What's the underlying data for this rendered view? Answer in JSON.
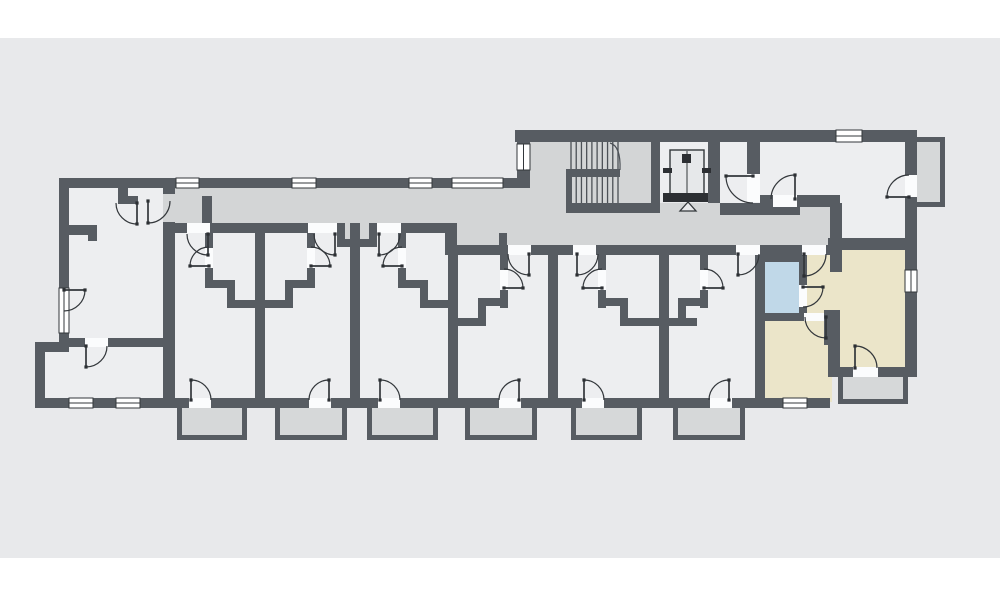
{
  "meta": {
    "title": "Apartment building floor plan",
    "canvas_w": 1000,
    "canvas_h": 600
  },
  "palette": {
    "page_bg": "#ffffff",
    "panel_bg": "#e8e9eb",
    "room": "#edeef0",
    "corridor": "#d3d5d6",
    "balcony": "#d6d8d9",
    "highlight_beige": "#ebe5c9",
    "highlight_blue": "#c0d8e8",
    "wall": "#575c62",
    "line": "#33373b",
    "stair_line": "#4b5056",
    "dark": "#2c2f33",
    "threshold": "#fbfcfd"
  },
  "panel": {
    "x": 0,
    "y": 38,
    "w": 1000,
    "h": 520
  },
  "plan": {
    "room_fills": [
      {
        "n": "room-left-lower",
        "x": 35,
        "y": 342,
        "w": 34,
        "h": 66
      },
      {
        "n": "room-left-wing",
        "x": 59,
        "y": 178,
        "w": 116,
        "h": 230
      },
      {
        "n": "rooms-strip",
        "x": 163,
        "y": 223,
        "w": 667,
        "h": 185
      },
      {
        "n": "room-top-right",
        "x": 718,
        "y": 142,
        "w": 189,
        "h": 100
      },
      {
        "n": "elevator-shaft",
        "x": 660,
        "y": 142,
        "w": 48,
        "h": 58
      }
    ],
    "corridor_fills": [
      {
        "n": "corridor-west",
        "x": 163,
        "y": 188,
        "w": 290,
        "h": 35
      },
      {
        "n": "corridor-mid",
        "x": 453,
        "y": 188,
        "w": 74,
        "h": 57
      },
      {
        "n": "stairwell",
        "x": 527,
        "y": 142,
        "w": 133,
        "h": 103
      },
      {
        "n": "corridor-east",
        "x": 652,
        "y": 203,
        "w": 186,
        "h": 42
      },
      {
        "n": "corridor-niche",
        "x": 345,
        "y": 223,
        "w": 24,
        "h": 16
      }
    ],
    "unit_fills": [
      {
        "n": "unit-hall",
        "x": 760,
        "y": 245,
        "w": 80,
        "h": 73,
        "c": "highlight_beige"
      },
      {
        "n": "unit-bedroom",
        "x": 755,
        "y": 318,
        "w": 77,
        "h": 84,
        "c": "highlight_beige"
      },
      {
        "n": "unit-living-room",
        "x": 832,
        "y": 242,
        "w": 75,
        "h": 133,
        "c": "highlight_beige"
      },
      {
        "n": "unit-bathroom",
        "x": 759,
        "y": 256,
        "w": 46,
        "h": 60,
        "c": "highlight_blue"
      }
    ],
    "balconies": [
      {
        "n": "balcony-1",
        "x": 177,
        "y": 408,
        "w": 70,
        "h": 32,
        "open": "top"
      },
      {
        "n": "balcony-2",
        "x": 275,
        "y": 408,
        "w": 72,
        "h": 32,
        "open": "top"
      },
      {
        "n": "balcony-3",
        "x": 367,
        "y": 408,
        "w": 71,
        "h": 32,
        "open": "top"
      },
      {
        "n": "balcony-4",
        "x": 465,
        "y": 408,
        "w": 72,
        "h": 32,
        "open": "top"
      },
      {
        "n": "balcony-5",
        "x": 571,
        "y": 408,
        "w": 71,
        "h": 32,
        "open": "top"
      },
      {
        "n": "balcony-6",
        "x": 673,
        "y": 408,
        "w": 72,
        "h": 32,
        "open": "top"
      },
      {
        "n": "balcony-unit",
        "x": 838,
        "y": 377,
        "w": 70,
        "h": 27,
        "open": "top"
      },
      {
        "n": "balcony-top-right",
        "x": 917,
        "y": 137,
        "w": 28,
        "h": 70,
        "open": "left"
      }
    ],
    "walls": [
      [
        59,
        178,
        468,
        10
      ],
      [
        59,
        178,
        10,
        112
      ],
      [
        59,
        333,
        10,
        14
      ],
      [
        35,
        342,
        34,
        10
      ],
      [
        35,
        342,
        10,
        66
      ],
      [
        35,
        398,
        140,
        10
      ],
      [
        163,
        188,
        12,
        6
      ],
      [
        163,
        222,
        12,
        176
      ],
      [
        118,
        188,
        10,
        16
      ],
      [
        118,
        196,
        20,
        8
      ],
      [
        60,
        225,
        37,
        10
      ],
      [
        88,
        225,
        9,
        16
      ],
      [
        69,
        338,
        16,
        9
      ],
      [
        108,
        338,
        57,
        9
      ],
      [
        163,
        223,
        24,
        10
      ],
      [
        210,
        223,
        98,
        10
      ],
      [
        337,
        223,
        8,
        24
      ],
      [
        369,
        223,
        8,
        24
      ],
      [
        337,
        239,
        40,
        8
      ],
      [
        401,
        223,
        49,
        10
      ],
      [
        202,
        196,
        10,
        27
      ],
      [
        445,
        223,
        12,
        32
      ],
      [
        499,
        233,
        8,
        12
      ],
      [
        445,
        245,
        63,
        10
      ],
      [
        531,
        245,
        42,
        10
      ],
      [
        596,
        245,
        140,
        10
      ],
      [
        760,
        245,
        42,
        10
      ],
      [
        826,
        245,
        16,
        10
      ],
      [
        255,
        223,
        10,
        175
      ],
      [
        350,
        223,
        10,
        175
      ],
      [
        448,
        255,
        10,
        143
      ],
      [
        548,
        255,
        10,
        143
      ],
      [
        659,
        255,
        10,
        143
      ],
      [
        755,
        255,
        10,
        143
      ],
      [
        175,
        398,
        14,
        10
      ],
      [
        211,
        398,
        98,
        10
      ],
      [
        331,
        398,
        47,
        10
      ],
      [
        400,
        398,
        99,
        10
      ],
      [
        521,
        398,
        61,
        10
      ],
      [
        604,
        398,
        106,
        10
      ],
      [
        731,
        398,
        99,
        10
      ],
      [
        205,
        233,
        8,
        15
      ],
      [
        205,
        268,
        8,
        20
      ],
      [
        205,
        280,
        30,
        8
      ],
      [
        227,
        280,
        8,
        28
      ],
      [
        227,
        300,
        30,
        8
      ],
      [
        307,
        233,
        8,
        15
      ],
      [
        307,
        268,
        8,
        20
      ],
      [
        285,
        280,
        30,
        8
      ],
      [
        285,
        280,
        8,
        28
      ],
      [
        265,
        300,
        28,
        8
      ],
      [
        398,
        233,
        8,
        15
      ],
      [
        398,
        268,
        8,
        20
      ],
      [
        398,
        280,
        30,
        8
      ],
      [
        420,
        280,
        8,
        28
      ],
      [
        420,
        300,
        30,
        8
      ],
      [
        500,
        255,
        8,
        15
      ],
      [
        500,
        290,
        8,
        18
      ],
      [
        478,
        298,
        30,
        8
      ],
      [
        478,
        298,
        8,
        28
      ],
      [
        458,
        318,
        28,
        8
      ],
      [
        598,
        255,
        8,
        15
      ],
      [
        598,
        290,
        8,
        18
      ],
      [
        598,
        298,
        30,
        8
      ],
      [
        620,
        298,
        8,
        28
      ],
      [
        620,
        318,
        39,
        8
      ],
      [
        700,
        255,
        8,
        15
      ],
      [
        700,
        290,
        8,
        18
      ],
      [
        678,
        298,
        30,
        8
      ],
      [
        678,
        298,
        8,
        28
      ],
      [
        669,
        318,
        28,
        8
      ],
      [
        515,
        130,
        402,
        12
      ],
      [
        517,
        141,
        13,
        47
      ],
      [
        566,
        203,
        94,
        10
      ],
      [
        651,
        142,
        9,
        67
      ],
      [
        708,
        142,
        12,
        61
      ],
      [
        720,
        203,
        80,
        12
      ],
      [
        747,
        142,
        13,
        32
      ],
      [
        760,
        195,
        13,
        12
      ],
      [
        797,
        195,
        43,
        12
      ],
      [
        830,
        203,
        12,
        69
      ],
      [
        828,
        238,
        80,
        12
      ],
      [
        755,
        254,
        47,
        8
      ],
      [
        799,
        254,
        8,
        31
      ],
      [
        799,
        307,
        8,
        6
      ],
      [
        755,
        313,
        49,
        8
      ],
      [
        824,
        313,
        10,
        32
      ],
      [
        824,
        310,
        16,
        10
      ],
      [
        828,
        320,
        12,
        47
      ],
      [
        828,
        367,
        25,
        10
      ],
      [
        878,
        367,
        30,
        10
      ],
      [
        905,
        133,
        12,
        42
      ],
      [
        905,
        197,
        12,
        73
      ],
      [
        905,
        292,
        12,
        85
      ]
    ],
    "thresholds": [
      [
        187,
        223,
        23,
        10
      ],
      [
        308,
        223,
        29,
        10
      ],
      [
        377,
        223,
        24,
        10
      ],
      [
        508,
        245,
        23,
        10
      ],
      [
        573,
        245,
        23,
        10
      ],
      [
        736,
        245,
        24,
        10
      ],
      [
        802,
        245,
        24,
        10
      ],
      [
        189,
        398,
        22,
        10
      ],
      [
        309,
        398,
        22,
        10
      ],
      [
        378,
        398,
        22,
        10
      ],
      [
        499,
        398,
        22,
        10
      ],
      [
        582,
        398,
        22,
        10
      ],
      [
        710,
        398,
        22,
        10
      ],
      [
        853,
        367,
        25,
        10
      ],
      [
        205,
        248,
        8,
        20
      ],
      [
        307,
        248,
        8,
        20
      ],
      [
        398,
        248,
        8,
        20
      ],
      [
        500,
        270,
        8,
        20
      ],
      [
        598,
        270,
        8,
        20
      ],
      [
        700,
        270,
        8,
        20
      ],
      [
        799,
        285,
        8,
        22
      ],
      [
        804,
        313,
        20,
        8
      ],
      [
        85,
        338,
        23,
        9
      ],
      [
        773,
        195,
        24,
        12
      ],
      [
        747,
        174,
        13,
        28
      ],
      [
        905,
        175,
        12,
        22
      ]
    ],
    "windows": [
      {
        "x": 176,
        "y": 178,
        "w": 23,
        "h": 10,
        "o": "h"
      },
      {
        "x": 292,
        "y": 178,
        "w": 24,
        "h": 10,
        "o": "h"
      },
      {
        "x": 409,
        "y": 178,
        "w": 23,
        "h": 10,
        "o": "h"
      },
      {
        "x": 452,
        "y": 178,
        "w": 51,
        "h": 10,
        "o": "h"
      },
      {
        "x": 836,
        "y": 130,
        "w": 26,
        "h": 12,
        "o": "h"
      },
      {
        "x": 59,
        "y": 288,
        "w": 10,
        "h": 45,
        "o": "v"
      },
      {
        "x": 69,
        "y": 398,
        "w": 24,
        "h": 10,
        "o": "h"
      },
      {
        "x": 116,
        "y": 398,
        "w": 24,
        "h": 10,
        "o": "h"
      },
      {
        "x": 783,
        "y": 398,
        "w": 24,
        "h": 10,
        "o": "h"
      },
      {
        "x": 905,
        "y": 270,
        "w": 12,
        "h": 22,
        "o": "v"
      },
      {
        "x": 517,
        "y": 144,
        "w": 13,
        "h": 26,
        "o": "v"
      }
    ],
    "doors": [
      {
        "n": "door-apt1-entry",
        "cx": 208,
        "cy": 234,
        "r": 21,
        "c": 180,
        "o": 90
      },
      {
        "n": "door-apt2-entry",
        "cx": 335,
        "cy": 234,
        "r": 21,
        "c": 180,
        "o": 90
      },
      {
        "n": "door-apt3-entry",
        "cx": 379,
        "cy": 234,
        "r": 21,
        "c": 0,
        "o": 90
      },
      {
        "n": "door-apt4-entry",
        "cx": 529,
        "cy": 254,
        "r": 21,
        "c": 180,
        "o": 90
      },
      {
        "n": "door-apt5-entry",
        "cx": 577,
        "cy": 254,
        "r": 21,
        "c": 0,
        "o": 90
      },
      {
        "n": "door-apt6-entry",
        "cx": 738,
        "cy": 254,
        "r": 21,
        "c": 0,
        "o": 90
      },
      {
        "n": "door-unit-entry",
        "cx": 804,
        "cy": 254,
        "r": 22,
        "c": 0,
        "o": 90
      },
      {
        "n": "door-unit-bathroom",
        "cx": 803,
        "cy": 287,
        "r": 20,
        "c": 90,
        "o": 0
      },
      {
        "n": "door-unit-bedroom",
        "cx": 826,
        "cy": 317,
        "r": 21,
        "c": 180,
        "o": 90
      },
      {
        "n": "door-unit-balcony",
        "cx": 855,
        "cy": 368,
        "r": 22,
        "c": 0,
        "o": 270
      },
      {
        "n": "door-apt1-balcony",
        "cx": 191,
        "cy": 400,
        "r": 20,
        "c": 0,
        "o": 270
      },
      {
        "n": "door-apt2-balcony",
        "cx": 329,
        "cy": 400,
        "r": 20,
        "c": 180,
        "o": 270
      },
      {
        "n": "door-apt3-balcony",
        "cx": 380,
        "cy": 400,
        "r": 20,
        "c": 0,
        "o": 270
      },
      {
        "n": "door-apt4-balcony",
        "cx": 519,
        "cy": 400,
        "r": 20,
        "c": 180,
        "o": 270
      },
      {
        "n": "door-apt5-balcony",
        "cx": 584,
        "cy": 400,
        "r": 20,
        "c": 0,
        "o": 270
      },
      {
        "n": "door-apt6-balcony",
        "cx": 729,
        "cy": 400,
        "r": 20,
        "c": 180,
        "o": 270
      },
      {
        "n": "door-apt1-bath",
        "cx": 209,
        "cy": 266,
        "r": 19,
        "c": 270,
        "o": 180
      },
      {
        "n": "door-apt2-bath",
        "cx": 311,
        "cy": 266,
        "r": 19,
        "c": 270,
        "o": 0
      },
      {
        "n": "door-apt3-bath",
        "cx": 402,
        "cy": 266,
        "r": 19,
        "c": 270,
        "o": 180
      },
      {
        "n": "door-apt4-bath",
        "cx": 504,
        "cy": 288,
        "r": 19,
        "c": 270,
        "o": 0
      },
      {
        "n": "door-apt5-bath",
        "cx": 602,
        "cy": 288,
        "r": 19,
        "c": 270,
        "o": 180
      },
      {
        "n": "door-apt6-bath",
        "cx": 704,
        "cy": 288,
        "r": 19,
        "c": 270,
        "o": 0
      },
      {
        "n": "door-left-room",
        "cx": 137,
        "cy": 203,
        "r": 21,
        "c": 180,
        "o": 90
      },
      {
        "n": "door-left-entry",
        "cx": 148,
        "cy": 201,
        "r": 22,
        "c": 0,
        "o": 90
      },
      {
        "n": "door-left-inner",
        "cx": 86,
        "cy": 346,
        "r": 21,
        "c": 0,
        "o": 90
      },
      {
        "n": "door-left-french",
        "cx": 64,
        "cy": 290,
        "r": 21,
        "c": 90,
        "o": 0
      },
      {
        "n": "door-utility",
        "cx": 753,
        "cy": 176,
        "r": 27,
        "c": 90,
        "o": 180
      },
      {
        "n": "door-top-right-room",
        "cx": 795,
        "cy": 199,
        "r": 24,
        "c": 180,
        "o": 270
      },
      {
        "n": "door-top-right-balcony",
        "cx": 909,
        "cy": 197,
        "r": 22,
        "c": 270,
        "o": 180
      }
    ],
    "stairs": {
      "treads": {
        "x0": 571,
        "x1": 618,
        "n": 10,
        "y0": 142,
        "y1": 203
      },
      "midbar": [
        566,
        169,
        54,
        8
      ],
      "stub": [
        566,
        169,
        6,
        34
      ],
      "walkline": "M 610 143 Q 621 146 620 170"
    },
    "elevator": {
      "car": [
        670,
        150,
        34,
        44
      ],
      "centerline": [
        687,
        151,
        687,
        193
      ],
      "box": [
        682,
        154,
        9,
        9
      ],
      "rails": [
        [
          663,
          168,
          9,
          5
        ],
        [
          702,
          168,
          9,
          5
        ]
      ],
      "door": [
        663,
        193,
        45,
        9
      ],
      "triangle": [
        [
          688,
          202
        ],
        [
          680,
          211
        ],
        [
          696,
          211
        ]
      ]
    }
  }
}
